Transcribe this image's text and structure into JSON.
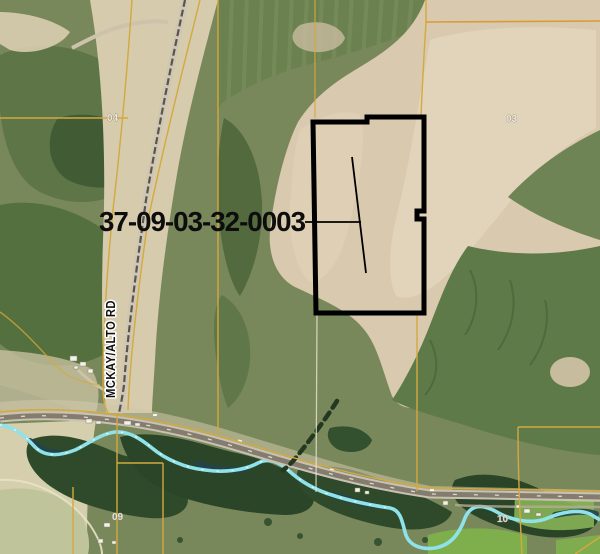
{
  "map": {
    "parcel_id_label": "37-09-03-32-0003",
    "road_label": "MCKAY/ALTO RD",
    "section_labels": {
      "nw": "04",
      "ne": "03",
      "sw": "09",
      "se": "10"
    },
    "colors": {
      "parcel_boundary_yellow": "#D4A93E",
      "section_line_orange": "#DA9A36",
      "survey_line_white": "#EDEADC",
      "highlight_outline_black": "#000000",
      "river_water": "#8FE2EA",
      "label_text": "#0D0D0D",
      "label_halo": "#FFFFFF",
      "section_label_white": "#F2EEE2"
    }
  }
}
